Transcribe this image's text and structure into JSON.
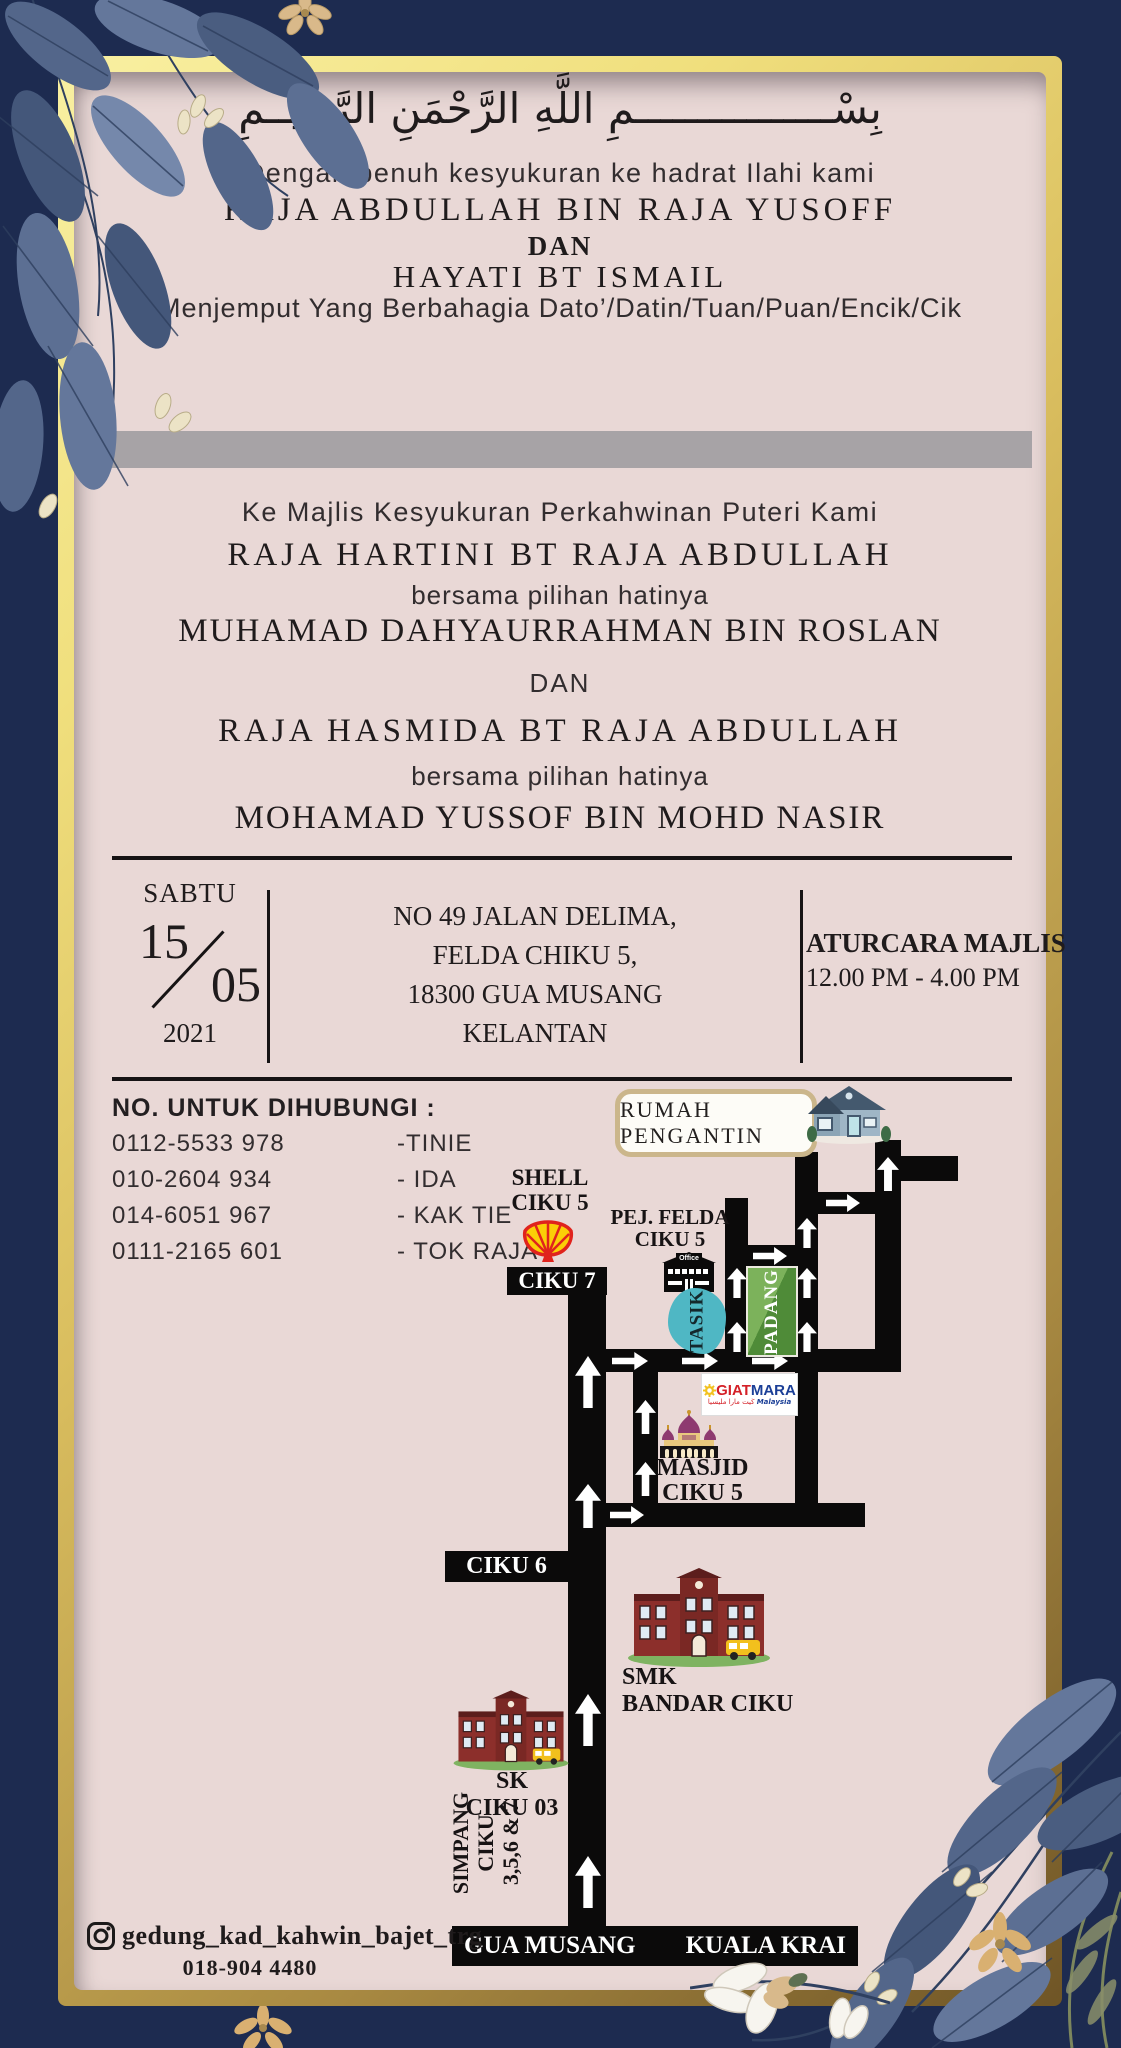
{
  "header": {
    "bismillah": "بِسْــــــــــــــــمِ اللَّهِ الرَّحْمَنِ الرَّحِيــمِ",
    "intro": "Dengan penuh kesyukuran ke hadrat Ilahi kami",
    "father_name": "RAJA ABDULLAH BIN RAJA YUSOFF",
    "and_1": "DAN",
    "mother_name": "HAYATI BT ISMAIL",
    "invite_line": "Menjemput Yang Berbahagia Dato’/Datin/Tuan/Puan/Encik/Cik"
  },
  "event": {
    "heading": "Ke Majlis Kesyukuran Perkahwinan Puteri Kami",
    "bride_1": "RAJA HARTINI BT RAJA ABDULLAH",
    "with_1": "bersama pilihan hatinya",
    "groom_1": "MUHAMAD DAHYAURRAHMAN BIN ROSLAN",
    "and_2": "DAN",
    "bride_2": "RAJA HASMIDA BT RAJA ABDULLAH",
    "with_2": "bersama pilihan hatinya",
    "groom_2": "MOHAMAD YUSSOF  BIN MOHD NASIR"
  },
  "details": {
    "day": "SABTU",
    "date_num": "15",
    "month": "05",
    "year": "2021",
    "address": [
      "NO 49 JALAN DELIMA,",
      "FELDA CHIKU 5,",
      "18300 GUA MUSANG",
      "KELANTAN"
    ],
    "agenda_title": "ATURCARA MAJLIS",
    "agenda_time": "12.00 PM - 4.00 PM"
  },
  "contacts": {
    "title": "NO. UNTUK DIHUBUNGI :",
    "list": [
      {
        "number": "0112-5533 978",
        "label": "-TINIE"
      },
      {
        "number": "010-2604 934",
        "label": "- IDA"
      },
      {
        "number": "014-6051 967",
        "label": "- KAK TIE"
      },
      {
        "number": "0111-2165 601",
        "label": "- TOK RAJA"
      }
    ]
  },
  "map": {
    "rumah_pengantin": "RUMAH PENGANTIN",
    "shell_line1": "SHELL",
    "shell_line2": "CIKU 5",
    "pej_felda_line1": "PEJ. FELDA",
    "pej_felda_line2": "CIKU 5",
    "office_sign": "Office",
    "ciku7": "CIKU 7",
    "ciku6": "CIKU 6",
    "tasik": "TASIK",
    "padang": "PADANG",
    "giatmara_giat": "GIAT",
    "giatmara_mara": "MARA",
    "giatmara_jawi": "ڬيت مارا مليسيا",
    "giatmara_sub": "Malaysia",
    "masjid_line1": "MASJID",
    "masjid_line2": "CIKU 5",
    "smk_line1": "SMK",
    "smk_line2": "BANDAR CIKU",
    "sk_line1": "SK",
    "sk_line2": "CIKU 03",
    "simpang_line1": "SIMPANG",
    "simpang_line2": "CIKU",
    "simpang_line3": "3,5,6 & 7",
    "road_left": "GUA MUSANG",
    "road_right": "KUALA KRAI"
  },
  "footer": {
    "instagram": "gedung_kad_kahwin_bajet_trg",
    "phone": "018-904 4480"
  },
  "colors": {
    "navy": "#1d2b50",
    "gold": "#e8d26d",
    "card_pink": "#e9d8d6",
    "gray_bar": "#a7a3a6",
    "road_black": "#0b0a0a",
    "tasik_teal": "#4fb7c4",
    "padang_green": "#4f8b38",
    "shell_red": "#e0231d",
    "shell_yellow": "#fbce07",
    "giat_red": "#d42027",
    "mara_blue": "#1b3f97",
    "masjid_purple": "#8e3a70",
    "school_brick": "#8c2f2b"
  }
}
